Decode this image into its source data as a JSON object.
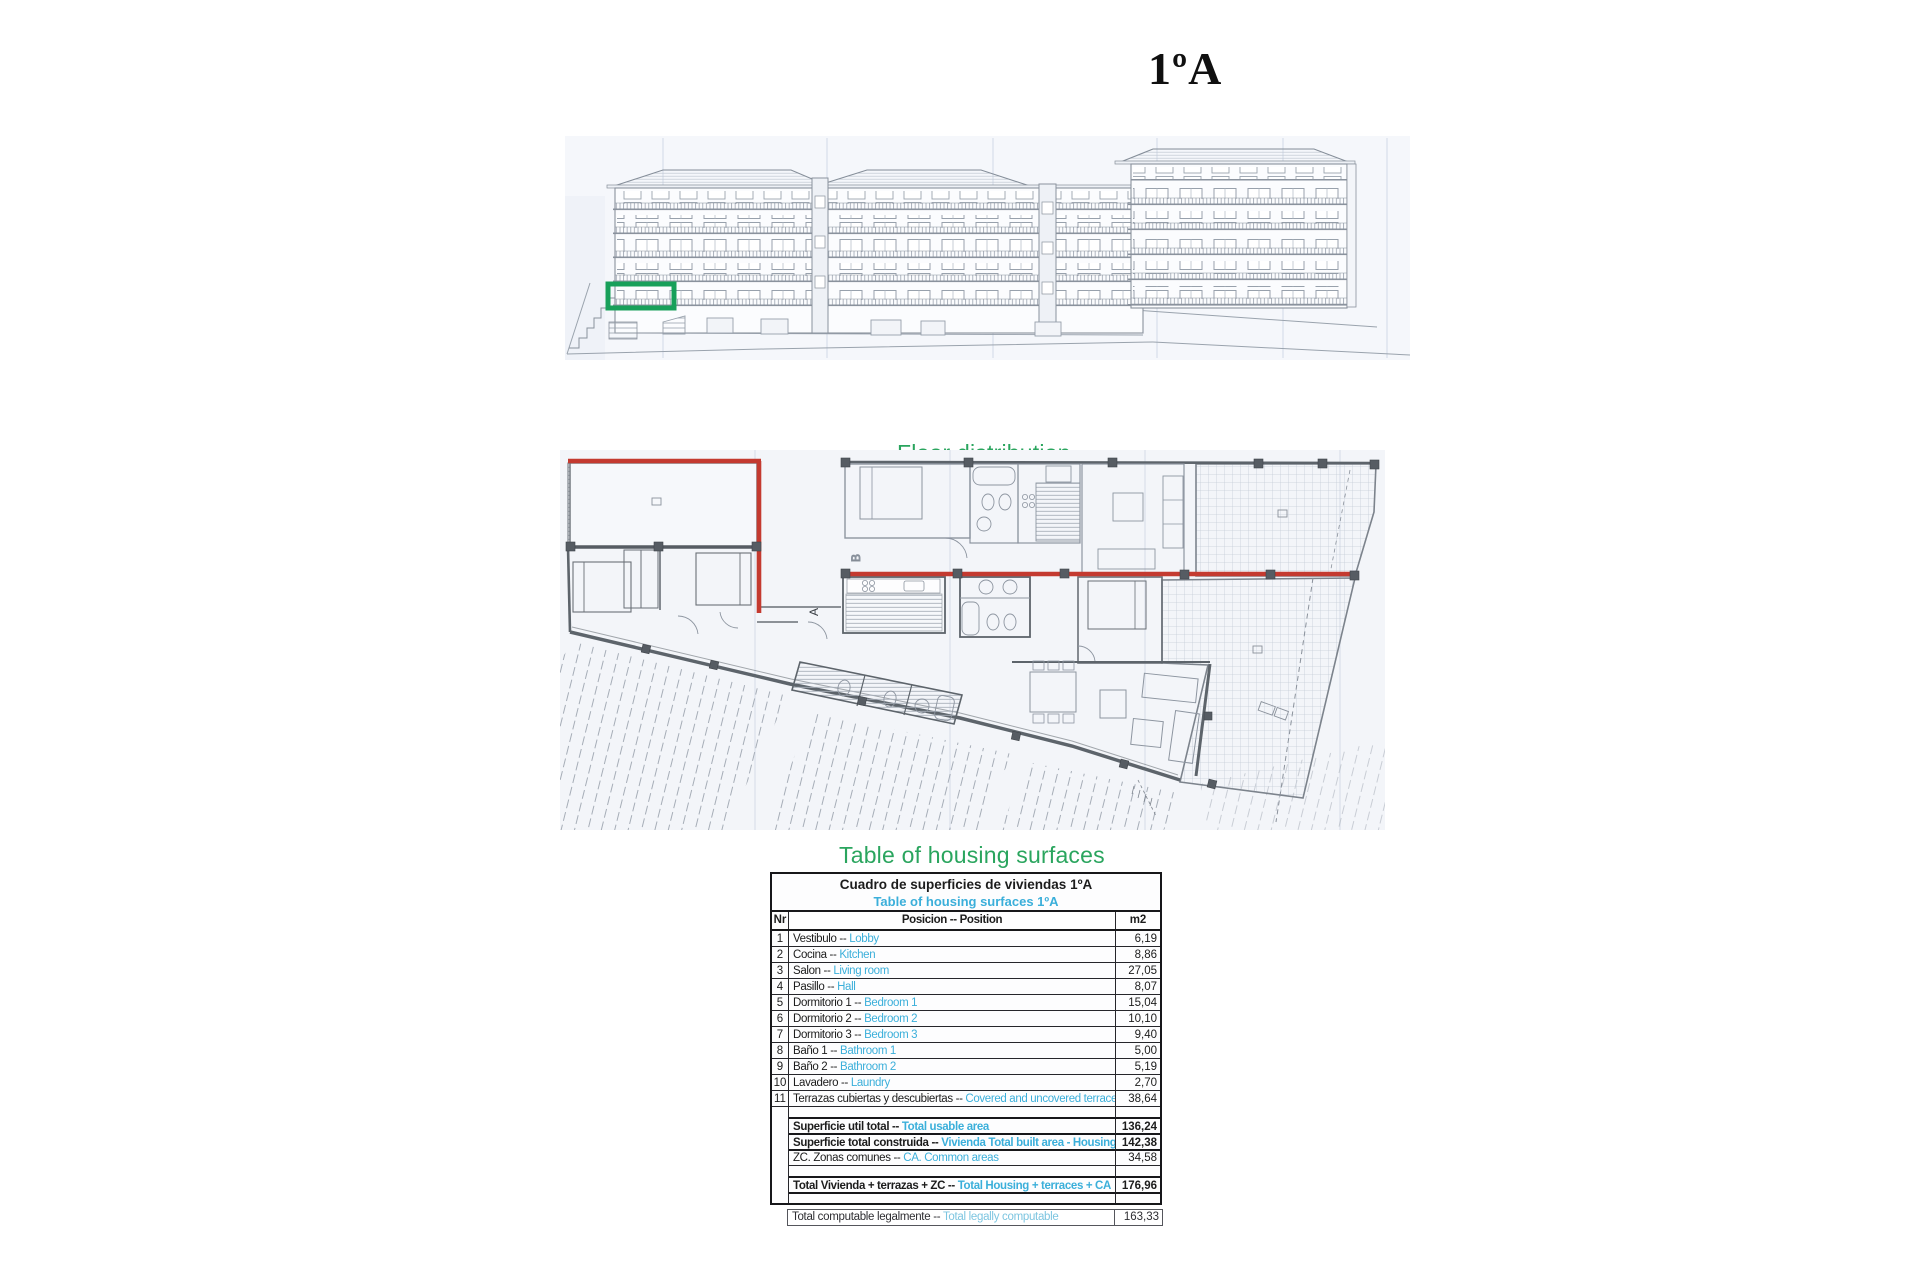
{
  "page": {
    "unit_title": "1ºA"
  },
  "colors": {
    "heading_green": "#2aa55e",
    "highlight_green": "#18a05a",
    "boundary_red": "#c43a30",
    "translation_cyan": "#3bafda"
  },
  "floor_plan": {
    "heading": "Floor distribution",
    "label_a": "A",
    "label_b": "B"
  },
  "surfaces": {
    "heading": "Table of housing surfaces",
    "table": {
      "title_es": "Cuadro de superficies de viviendas 1ºA",
      "title_en": "Table of housing surfaces 1ºA",
      "separator": " -- ",
      "columns": {
        "nr": "Nr",
        "position": "Posicion -- Position",
        "m2": "m2"
      },
      "rows": [
        {
          "nr": "1",
          "es": "Vestibulo",
          "en": "Lobby",
          "m2": "6,19"
        },
        {
          "nr": "2",
          "es": "Cocina",
          "en": " Kitchen",
          "m2": "8,86"
        },
        {
          "nr": "3",
          "es": "Salon",
          "en": "Living room",
          "m2": "27,05"
        },
        {
          "nr": "4",
          "es": "Pasillo",
          "en": "Hall",
          "m2": "8,07"
        },
        {
          "nr": "5",
          "es": "Dormitorio 1",
          "en": "Bedroom 1",
          "m2": "15,04"
        },
        {
          "nr": "6",
          "es": "Dormitorio 2",
          "en": "Bedroom 2",
          "m2": "10,10"
        },
        {
          "nr": "7",
          "es": "Dormitorio 3",
          "en": "Bedroom 3",
          "m2": "9,40"
        },
        {
          "nr": "8",
          "es": "Baño 1",
          "en": "Bathroom 1",
          "m2": "5,00"
        },
        {
          "nr": "9",
          "es": "Baño 2",
          "en": "Bathroom 2",
          "m2": "5,19"
        },
        {
          "nr": "10",
          "es": "Lavadero",
          "en": "Laundry",
          "m2": "2,70"
        },
        {
          "nr": "11",
          "es": "Terrazas cubiertas y descubiertas",
          "en": "Covered and uncovered terraces",
          "m2": "38,64"
        }
      ],
      "summary": [
        {
          "type": "spacer"
        },
        {
          "es": "Superficie util total",
          "en": "Total usable area",
          "m2": "136,24",
          "bold": true
        },
        {
          "es": "Superficie total construida",
          "en": "Vivienda Total built area - Housing",
          "m2": "142,38",
          "bold": true
        },
        {
          "es": "ZC. Zonas comunes ",
          "en": "CA. Common areas",
          "m2": "34,58",
          "bold": false
        },
        {
          "type": "spacer"
        },
        {
          "es": "Total Vivienda + terrazas + ZC ",
          "en": "Total Housing + terraces + CA",
          "m2": "176,96",
          "bold": true
        },
        {
          "type": "spacer"
        }
      ],
      "footer": {
        "es": "Total computable legalmente",
        "en": "Total legally computable",
        "m2": "163,33"
      }
    }
  }
}
